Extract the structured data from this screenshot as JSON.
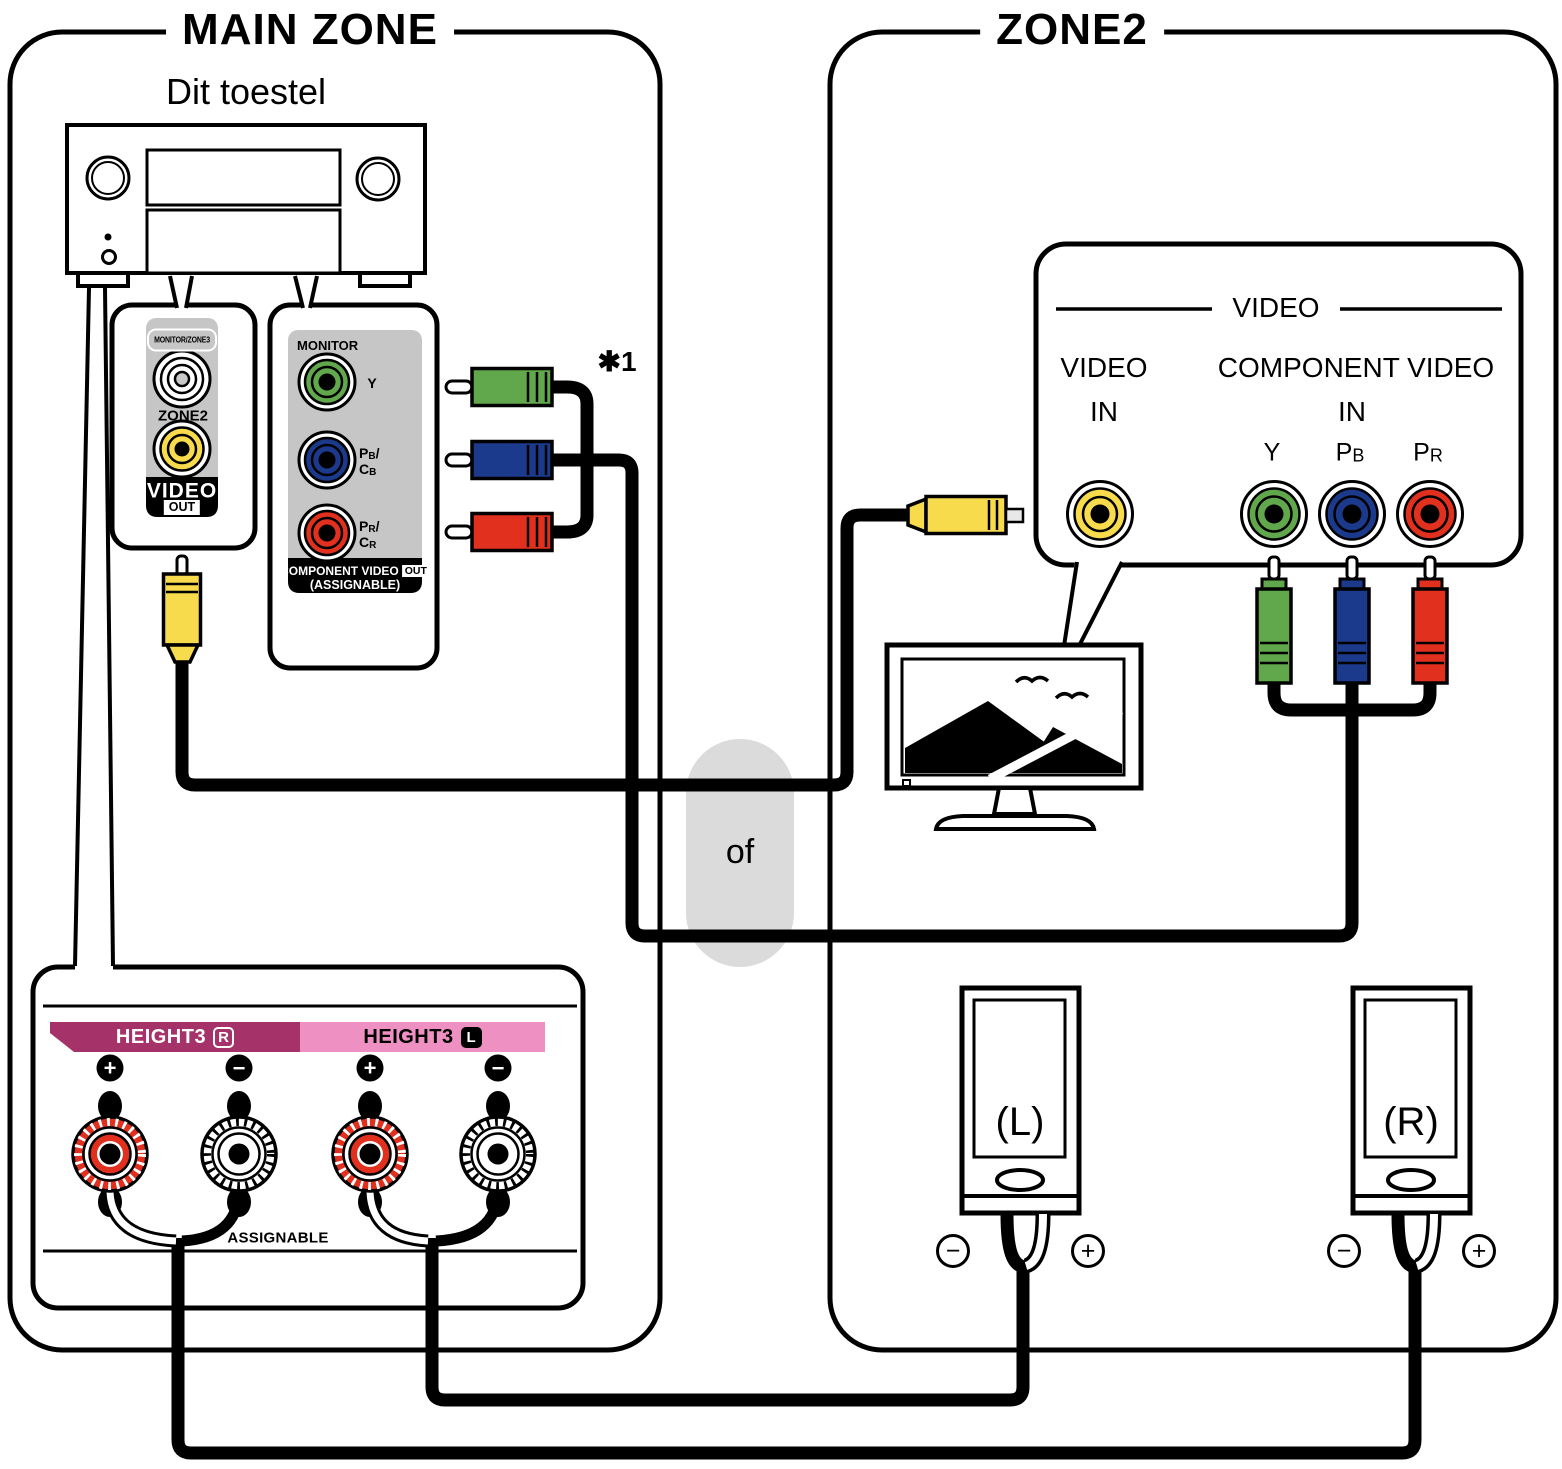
{
  "colors": {
    "yellow": "#F7DB4D",
    "green": "#61A74B",
    "blue": "#1B3A8C",
    "red": "#E2301F",
    "plate-gray": "#C6C6C6",
    "capsule-gray": "#DBDBDB",
    "banner-dark": "#A53369",
    "banner-pink": "#EE90C2",
    "jack-center-gray": "#C9C9C9"
  },
  "main_zone": {
    "title": "MAIN ZONE",
    "device_label": "Dit toestel",
    "cable_note": "✱1",
    "video_out_panel": {
      "top_label": "MONITOR/ZONE3",
      "jack2_label": "ZONE2",
      "footer_title": "VIDEO",
      "footer_badge": "OUT"
    },
    "component_out_panel": {
      "top_label": "MONITOR",
      "y_label": "Y",
      "pb_main": "P",
      "pb_sub": "B",
      "pb_slash": "/",
      "cb_main": "C",
      "cb_sub": "B",
      "pr_main": "P",
      "pr_sub": "R",
      "pr_slash": "/",
      "cr_main": "C",
      "cr_sub": "R",
      "footer_title": "COMPONENT VIDEO",
      "footer_badge": "OUT",
      "footer_sub": "(ASSIGNABLE)"
    }
  },
  "middle": {
    "or_label": "of"
  },
  "zone2": {
    "title": "ZONE2",
    "video_panel": {
      "panel_title": "VIDEO",
      "video_label": "VIDEO",
      "video_sub_label": "IN",
      "component_label": "COMPONENT VIDEO",
      "component_sub_label": "IN",
      "y_label": "Y",
      "pb_main": "P",
      "pb_sub": "B",
      "pr_main": "P",
      "pr_sub": "R"
    }
  },
  "speaker_panel": {
    "banner_right": "HEIGHT3",
    "banner_right_badge": "R",
    "banner_left": "HEIGHT3",
    "banner_left_badge": "L",
    "posts": [
      {
        "sign": "+"
      },
      {
        "sign": "−"
      },
      {
        "sign": "+"
      },
      {
        "sign": "−"
      }
    ],
    "assignable_label": "ASSIGNABLE"
  },
  "speakers": {
    "left_label": "(L)",
    "right_label": "(R)",
    "minus_sign": "−",
    "plus_sign": "+"
  }
}
